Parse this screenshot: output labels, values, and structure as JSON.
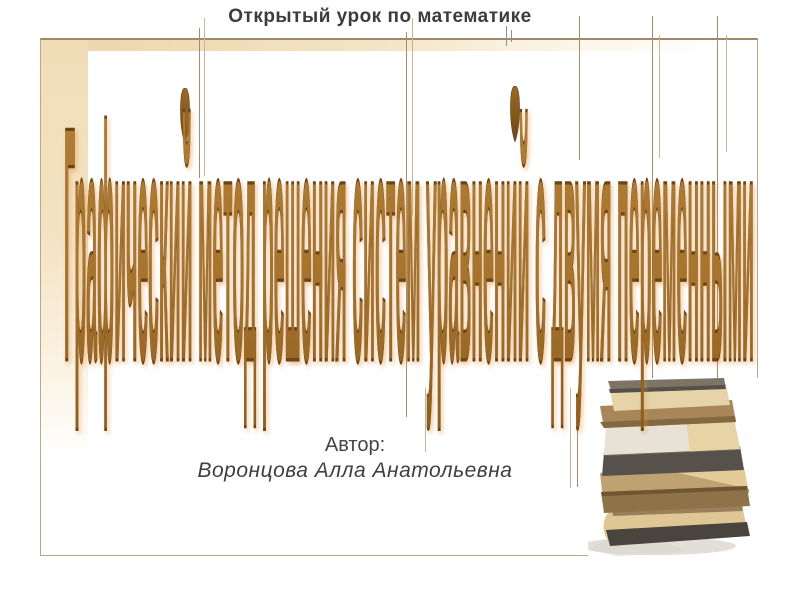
{
  "slide": {
    "title": "Открытый урок по математике",
    "heading": "Графический метод решения систем уравнений с двумя переменными",
    "author": {
      "label": "Автор:",
      "name": "Воронцова Алла Анатольевна"
    }
  },
  "decor": {
    "books_photo": "stack-of-old-books-photo",
    "leaf_ornaments": 2,
    "accent_colors": {
      "heading_brown": "#a6742e",
      "heading_outline": "#6b4417",
      "heading_glow": "#e89840",
      "frame_beige": "#eed5ac",
      "frame_border": "#bca887",
      "book_pages": "#dfc795",
      "book_cover_dark": "#4a443e",
      "title_text": "#3c3c3c"
    }
  }
}
